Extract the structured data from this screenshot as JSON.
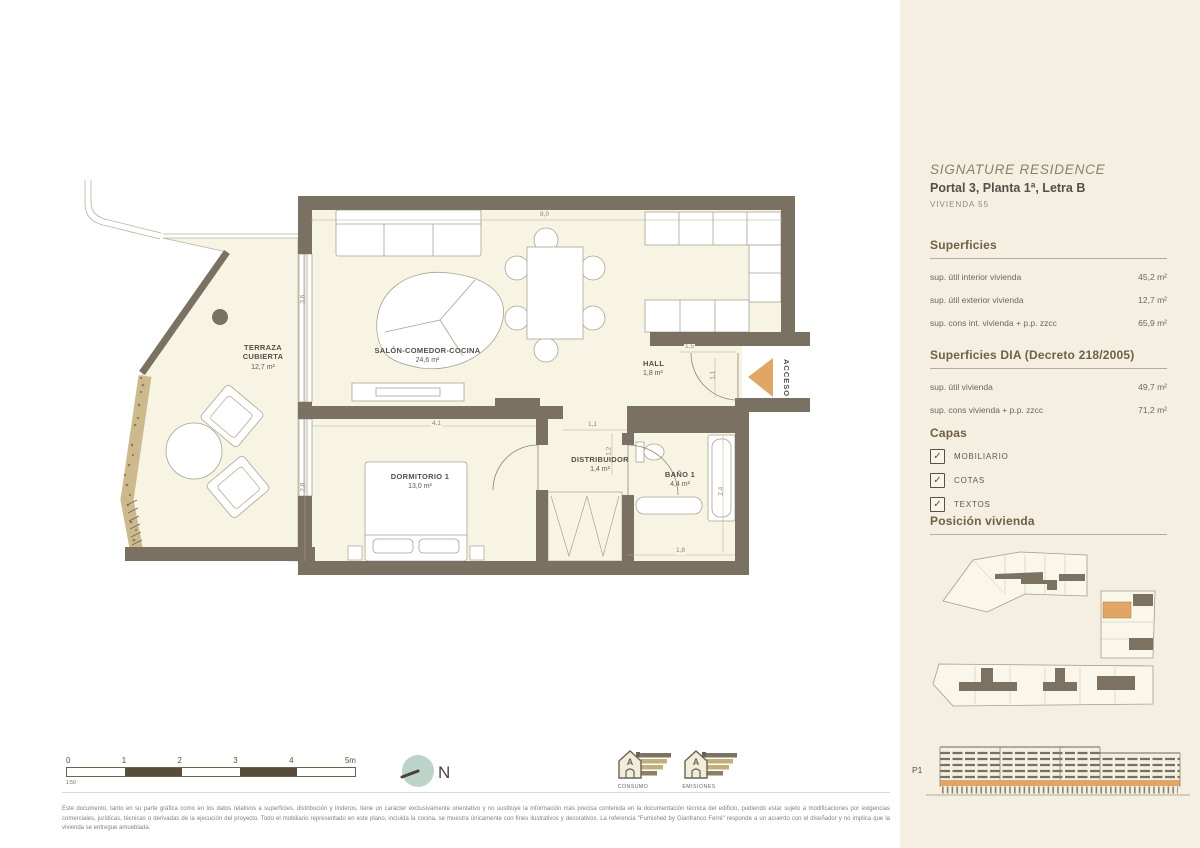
{
  "sidebar": {
    "brand": "SIGNATURE RESIDENCE",
    "unit_title": "Portal 3, Planta 1ª, Letra B",
    "unit_subtitle": "VIVIENDA 55",
    "superficies": {
      "heading": "Superficies",
      "rows": [
        {
          "label": "sup. útil interior vivienda",
          "value": "45,2 m²"
        },
        {
          "label": "sup. útil exterior vivienda",
          "value": "12,7 m²"
        },
        {
          "label": "sup. cons int. vivienda + p.p. zzcc",
          "value": "65,9 m²"
        }
      ]
    },
    "superficies_dia": {
      "heading": "Superficies DIA (Decreto 218/2005)",
      "rows": [
        {
          "label": "sup. útil vivienda",
          "value": "49,7 m²"
        },
        {
          "label": "sup. cons vivienda + p.p. zzcc",
          "value": "71,2 m²"
        }
      ]
    },
    "capas": {
      "heading": "Capas",
      "check_glyph": "✓",
      "items": [
        {
          "label": "MOBILIARIO",
          "checked": true
        },
        {
          "label": "COTAS",
          "checked": true
        },
        {
          "label": "TEXTOS",
          "checked": true
        }
      ]
    },
    "posicion_heading": "Posición vivienda",
    "elevation_label": "P1"
  },
  "plan": {
    "rooms": {
      "terraza": {
        "name": "TERRAZA CUBIERTA",
        "area": "12,7 m²"
      },
      "salon": {
        "name": "SALÓN-COMEDOR-COCINA",
        "area": "24,6 m²"
      },
      "dormitorio": {
        "name": "DORMITORIO 1",
        "area": "13,0 m²"
      },
      "hall": {
        "name": "HALL",
        "area": "1,8 m²"
      },
      "distribuidor": {
        "name": "DISTRIBUIDOR",
        "area": "1,4 m²"
      },
      "bano": {
        "name": "BAÑO 1",
        "area": "4,4 m²"
      }
    },
    "access_label": "ACCESO",
    "north_label": "N",
    "dimensions": [
      "8,0",
      "3,6",
      "4,1",
      "2,8",
      "1,5",
      "1,1",
      "1,1",
      "1,2",
      "1,8",
      "2,4"
    ]
  },
  "footer": {
    "scale": {
      "ticks": [
        "0",
        "1",
        "2",
        "3",
        "4",
        "5m"
      ],
      "ratio": "1:50"
    },
    "energy": [
      {
        "label": "CONSUMO",
        "grade": "A"
      },
      {
        "label": "EMISIONES",
        "grade": "A"
      }
    ],
    "disclaimer": "Este documento, tanto en su parte gráfica como en los datos relativos a superficies, distribución y linderos, tiene un carácter exclusivamente orientativo y no sustituye la información más precisa contenida en la documentación técnica del edificio, pudiendo estar sujeto a modificaciones por exigencias comerciales, jurídicas, técnicas o derivadas de la ejecución del proyecto. Todo el mobiliario representado en este plano, incluida la cocina, se muestra únicamente con fines ilustrativos y decorativos. La referencia \"Furnished by Gianfranco Ferré\" responde a un acuerdo con el diseñador y no implica que la vivienda se entregue amueblada."
  }
}
